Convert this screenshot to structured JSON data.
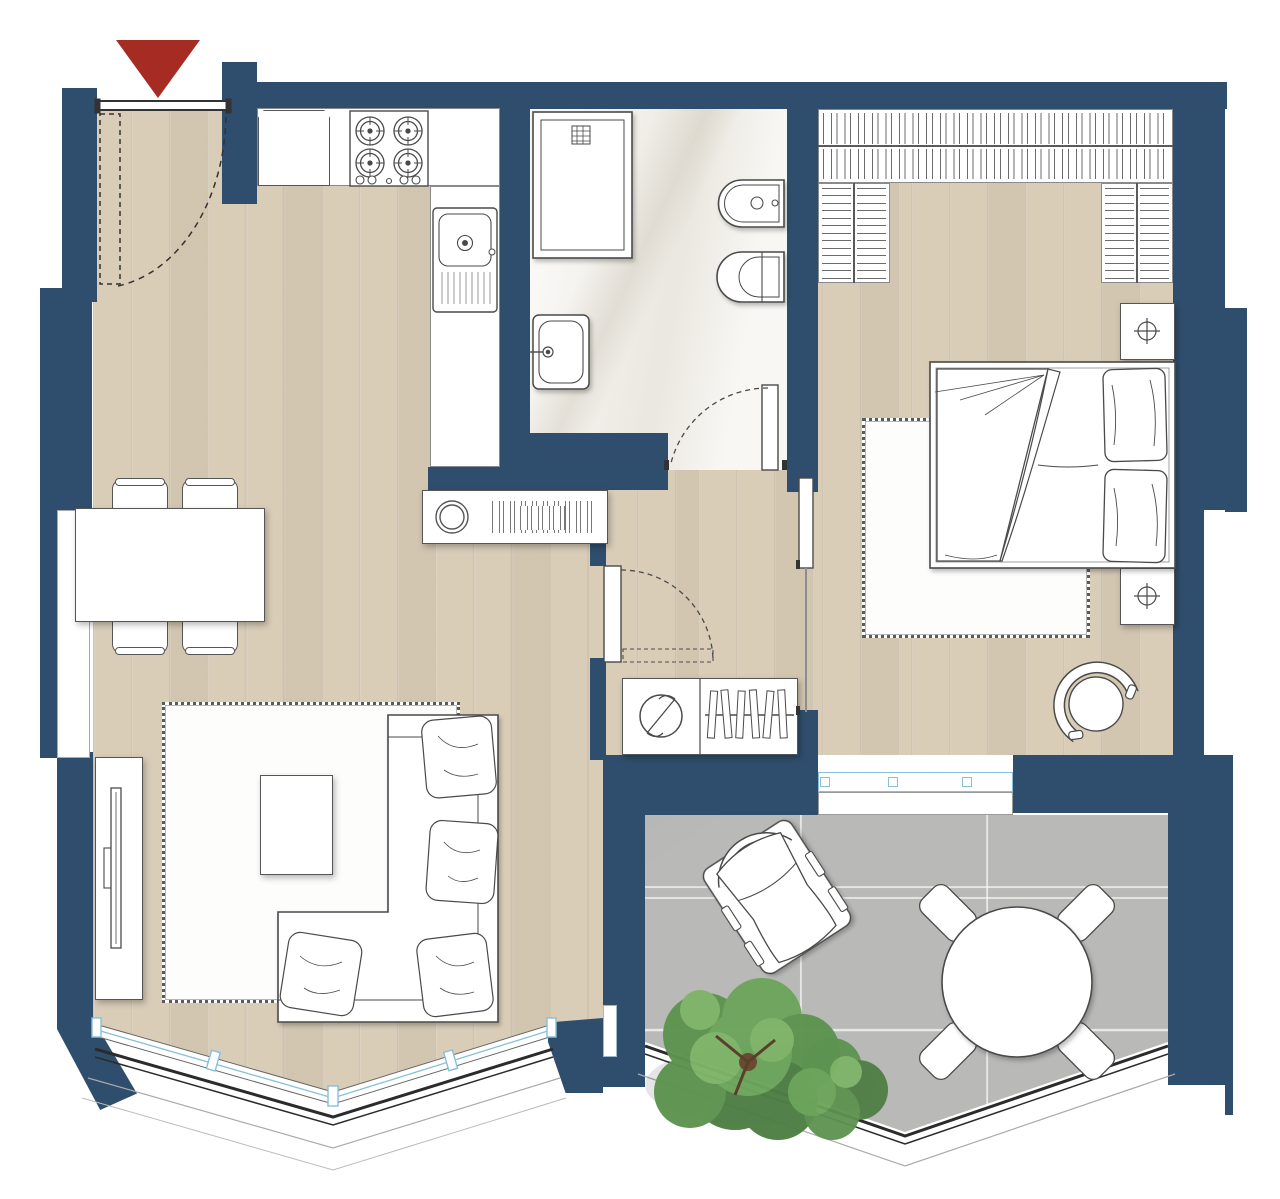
{
  "document": {
    "kind": "residential apartment floor plan, top-down architectural drawing",
    "visible_text": "none"
  },
  "colors": {
    "wall": "#2f4e6d",
    "floor_wood": "#d9cdb8",
    "floor_bath": "#f1efe9",
    "floor_terrace": "#b9b9b8",
    "line": "#4a4a4a",
    "window_blue": "#87c0d8",
    "accent_red": "#a62b22",
    "tree_dark": "#4e7f44",
    "tree_mid": "#5d9350",
    "tree_light": "#7eb468",
    "trunk": "#6b4a33"
  },
  "plan": {
    "entrance_marker": "red-triangle-pointing-down",
    "rooms": [
      {
        "name": "living-dining",
        "floor": "wood-planks",
        "items": [
          "entrance-door-with-swing-arc",
          "dining-table",
          "dining-chairs-x4",
          "side-window",
          "tv-unit",
          "tv",
          "area-rug",
          "coffee-table",
          "corner-sofa-with-cushions",
          "sideboard-with-bowl-and-books",
          "angled-bay-window",
          "balcony-railing"
        ]
      },
      {
        "name": "kitchen",
        "floor": "wood-planks",
        "items": [
          "refrigerator",
          "gas-hob-4-burners",
          "counter-run",
          "sink-with-drainboard"
        ]
      },
      {
        "name": "bathroom",
        "floor": "marble",
        "items": [
          "shower-tray-with-drain",
          "washbasin",
          "bidet",
          "toilet",
          "hinged-door-with-swing-arc"
        ]
      },
      {
        "name": "hallway",
        "floor": "wood-planks",
        "items": [
          "door-to-living-with-swing-arc",
          "sliding-door-to-bedroom",
          "closet-with-washing-machine",
          "closet-hanging-rail-with-hangers"
        ]
      },
      {
        "name": "bedroom",
        "floor": "wood-planks",
        "items": [
          "u-shaped-wardrobe-with-hangers",
          "double-bed-with-duvet",
          "pillows-x2",
          "nightstands-x2",
          "lamps-x2",
          "area-rug",
          "round-armchair",
          "window-to-terrace"
        ]
      },
      {
        "name": "terrace",
        "floor": "stone-tiles",
        "items": [
          "lounge-chair",
          "round-outdoor-table",
          "outdoor-chairs-x4",
          "trees-x2",
          "v-shaped-perimeter-railing"
        ]
      }
    ]
  }
}
